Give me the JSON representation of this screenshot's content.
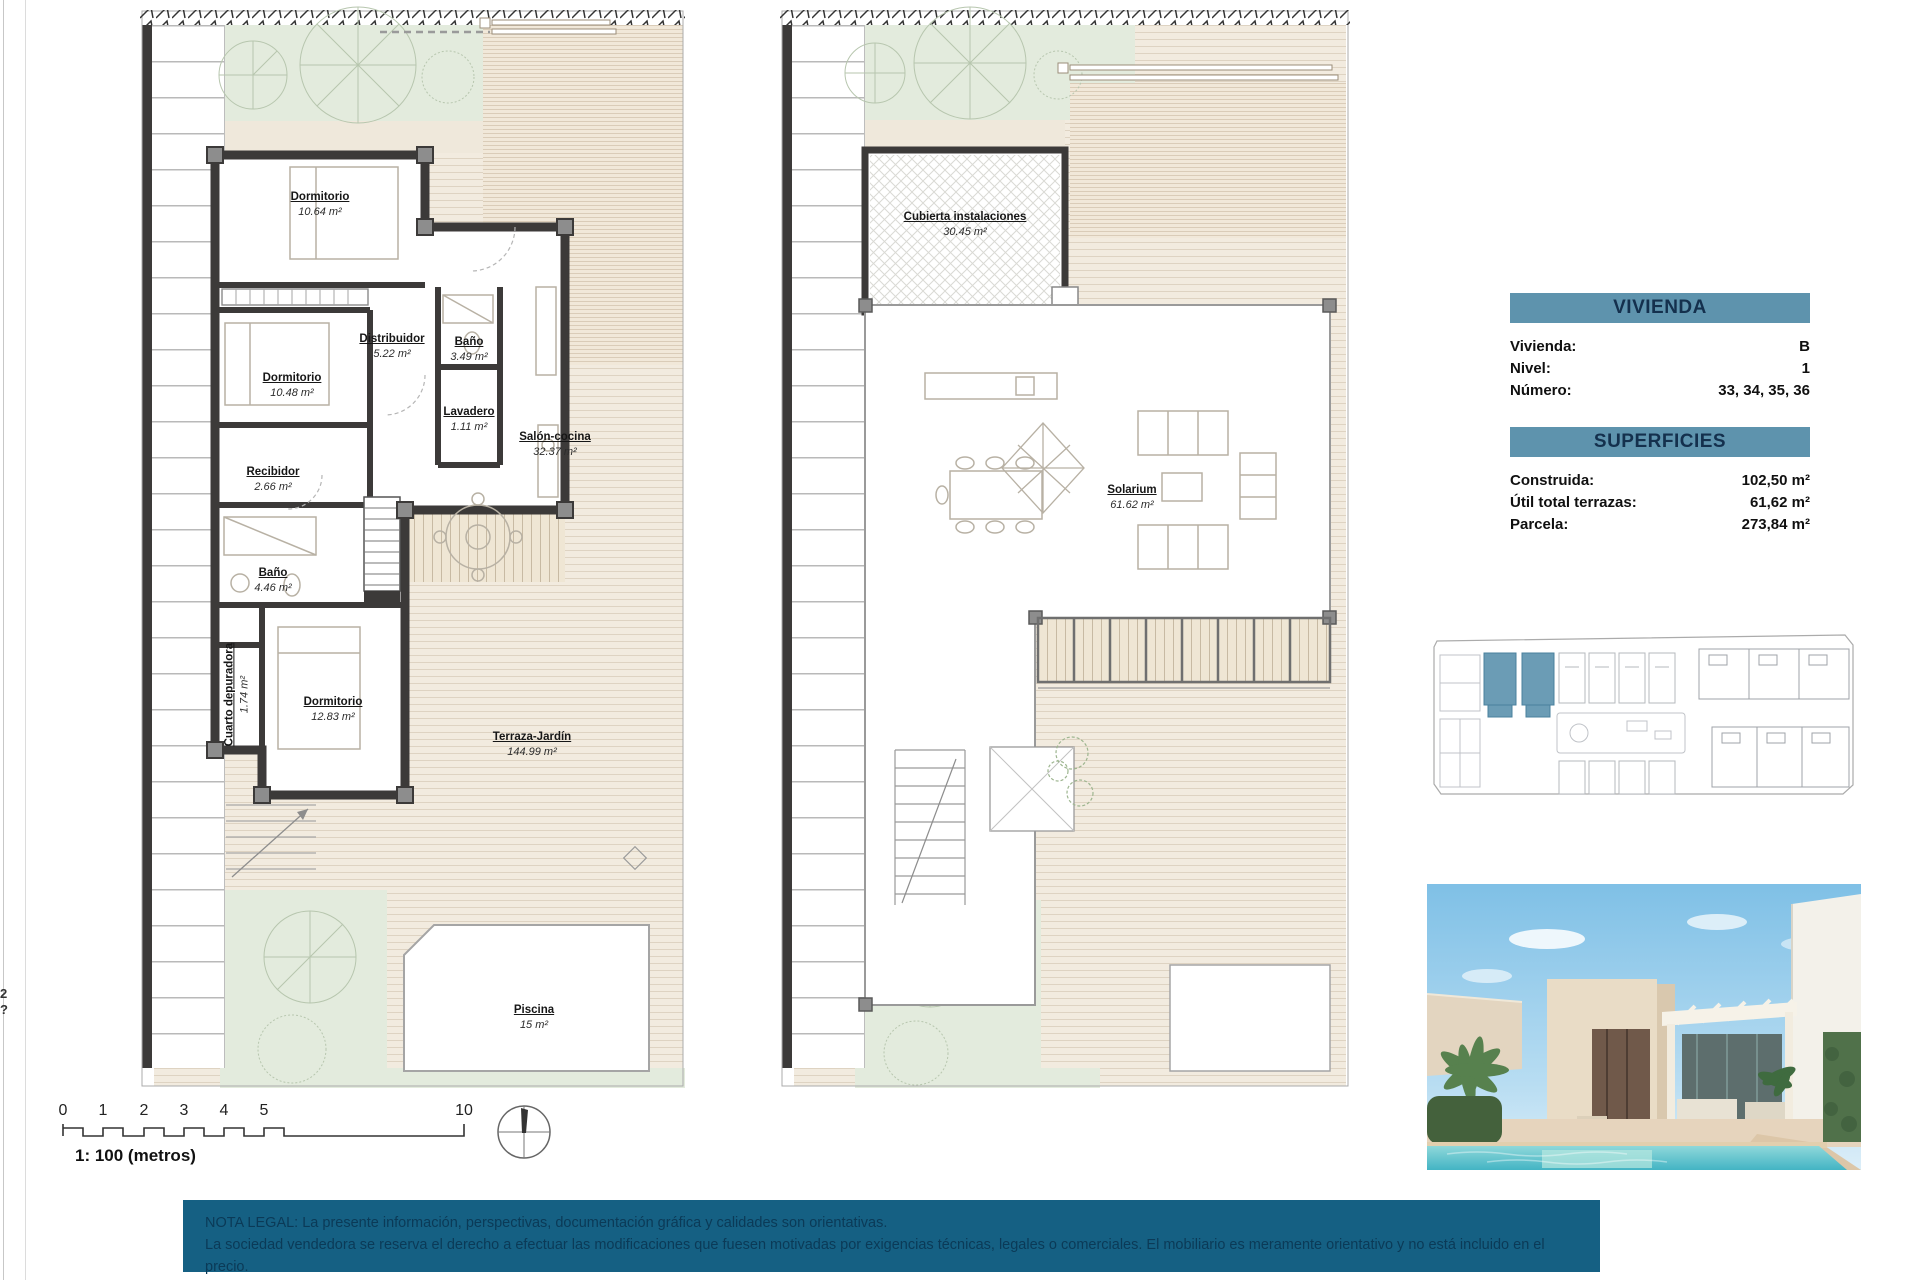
{
  "sheet": {
    "edge_marks": {
      "top": "2",
      "bottom": "?"
    },
    "scale_bar": {
      "ticks": [
        "0",
        "1",
        "2",
        "3",
        "4",
        "5",
        "10"
      ],
      "caption": "1: 100 (metros)"
    },
    "legal": {
      "line1": "NOTA LEGAL: La presente información, perspectivas, documentación gráfica y calidades son orientativas.",
      "line2": "La sociedad vendedora se reserva el derecho a efectuar las modificaciones que fuesen motivadas por exigencias técnicas, legales o comerciales. El mobiliario es meramente orientativo y no está incluido en el precio."
    }
  },
  "ground_floor": {
    "rooms": [
      {
        "name": "Dormitorio",
        "area": "10.64 m²"
      },
      {
        "name": "Distribuidor",
        "area": "5.22 m²"
      },
      {
        "name": "Baño",
        "area": "3.49 m²"
      },
      {
        "name": "Dormitorio",
        "area": "10.48 m²"
      },
      {
        "name": "Lavadero",
        "area": "1.11 m²"
      },
      {
        "name": "Salón-cocina",
        "area": "32.37 m²"
      },
      {
        "name": "Recibidor",
        "area": "2.66 m²"
      },
      {
        "name": "Baño",
        "area": "4.46 m²"
      },
      {
        "name": "Cuarto depuradora",
        "area": "1.74 m²"
      },
      {
        "name": "Dormitorio",
        "area": "12.83 m²"
      },
      {
        "name": "Terraza-Jardín",
        "area": "144.99 m²"
      },
      {
        "name": "Piscina",
        "area": "15 m²"
      }
    ]
  },
  "roof_floor": {
    "rooms": [
      {
        "name": "Cubierta instalaciones",
        "area": "30.45 m²"
      },
      {
        "name": "Solarium",
        "area": "61.62 m²"
      }
    ]
  },
  "panels": {
    "vivienda": {
      "title": "VIVIENDA",
      "rows": [
        {
          "label": "Vivienda:",
          "value": "B"
        },
        {
          "label": "Nivel:",
          "value": "1"
        },
        {
          "label": "Número:",
          "value": "33, 34, 35, 36"
        }
      ]
    },
    "superficies": {
      "title": "SUPERFICIES",
      "rows": [
        {
          "label": "Construida:",
          "value": "102,50 m²"
        },
        {
          "label": "Útil total terrazas:",
          "value": "61,62 m²"
        },
        {
          "label": "Parcela:",
          "value": "273,84 m²"
        }
      ]
    }
  },
  "colors": {
    "accent": "#5e93ad",
    "legal_bg": "#156083",
    "wall": "#3c3a39",
    "deck": "#f2ebdf",
    "garden": "#e3ebdd",
    "site_highlight": "#6b9cb5"
  }
}
